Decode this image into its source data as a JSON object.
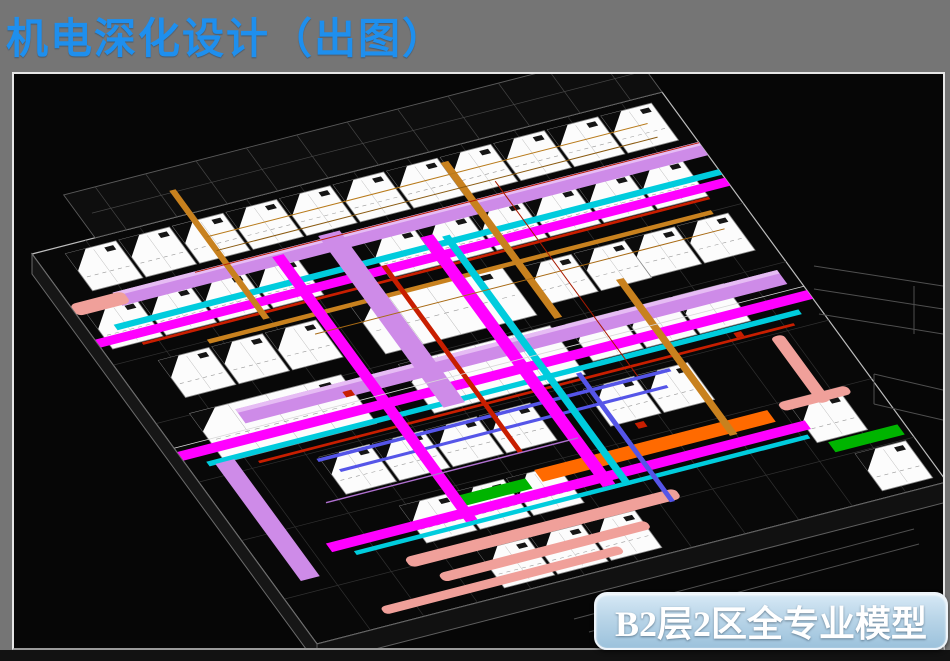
{
  "slide": {
    "title": "机电深化设计（出图）",
    "caption": "B2层2区全专业模型"
  },
  "palette": {
    "slide_background": "#757575",
    "title_color": "#1E8FEE",
    "canvas_background": "#060606",
    "frame_border": "#E6E6E6",
    "badge_border": "#EDF4FA",
    "badge_gradient_top": "#D7E9F6",
    "badge_gradient_bottom": "#9CC2DC",
    "badge_text_color": "#FFFFFF",
    "duct_violet": "#CE8BE8",
    "duct_magenta": "#FF00FF",
    "duct_cyan": "#00CCDD",
    "duct_red": "#C81E00",
    "duct_orange": "#C8811E",
    "duct_orange_bright": "#FF6A00",
    "duct_green": "#00B400",
    "duct_salmon": "#F0A09A",
    "duct_blue": "#5555E8",
    "room_fill": "#FCFCFC",
    "wireframe": "#555555"
  }
}
